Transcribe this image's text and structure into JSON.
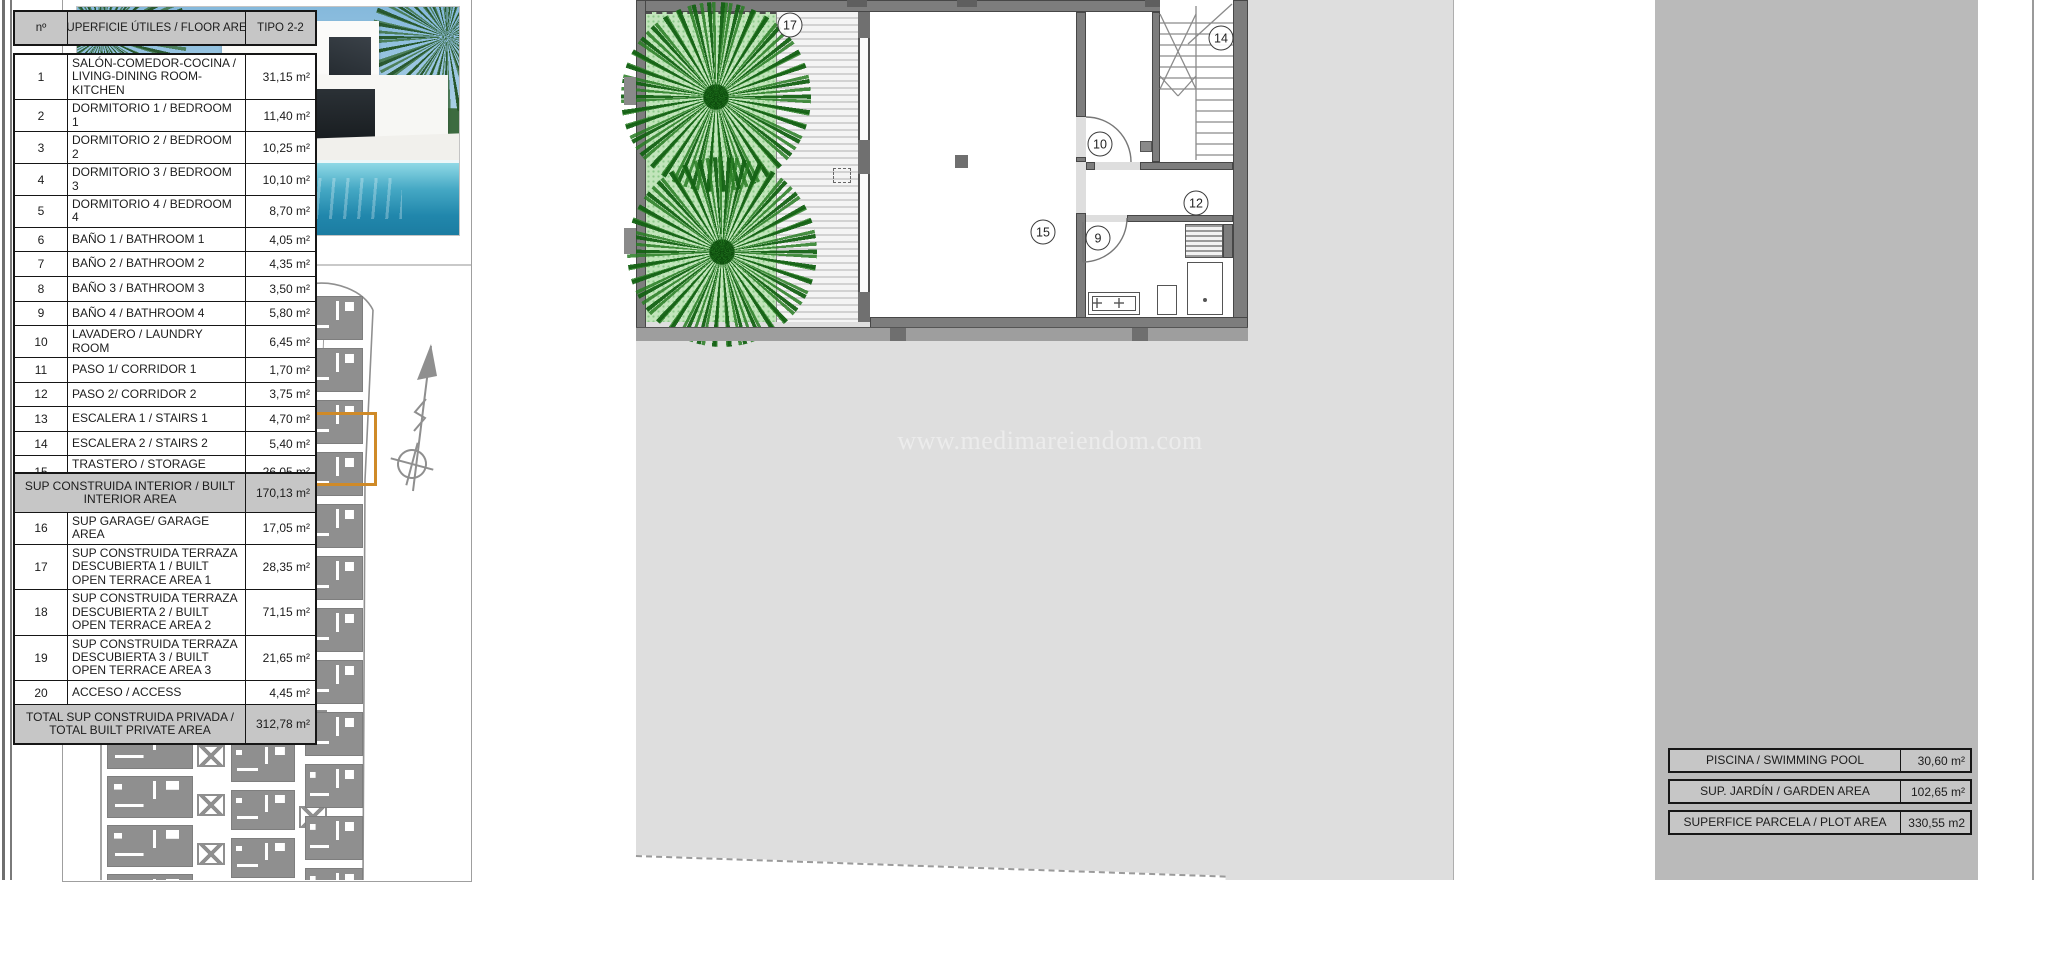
{
  "document": {
    "watermark": "www.medimareiendom.com"
  },
  "area_table": {
    "header": {
      "num": "nº",
      "desc": "SUPERFICIE ÚTILES / FLOOR AREA",
      "type": "TIPO 2-2"
    },
    "rooms": [
      {
        "num": "1",
        "label": "SALÓN-COMEDOR-COCINA / LIVING-DINING ROOM-KITCHEN",
        "value": "31,15 m²"
      },
      {
        "num": "2",
        "label": "DORMITORIO 1 / BEDROOM 1",
        "value": "11,40 m²"
      },
      {
        "num": "3",
        "label": "DORMITORIO 2 / BEDROOM 2",
        "value": "10,25 m²"
      },
      {
        "num": "4",
        "label": "DORMITORIO 3 / BEDROOM 3",
        "value": "10,10 m²"
      },
      {
        "num": "5",
        "label": "DORMITORIO 4 / BEDROOM 4",
        "value": "8,70 m²"
      },
      {
        "num": "6",
        "label": "BAÑO 1 / BATHROOM 1",
        "value": "4,05 m²"
      },
      {
        "num": "7",
        "label": "BAÑO 2 / BATHROOM 2",
        "value": "4,35 m²"
      },
      {
        "num": "8",
        "label": "BAÑO 3 / BATHROOM 3",
        "value": "3,50 m²"
      },
      {
        "num": "9",
        "label": "BAÑO 4 / BATHROOM 4",
        "value": "5,80 m²"
      },
      {
        "num": "10",
        "label": "LAVADERO / LAUNDRY ROOM",
        "value": "6,45 m²"
      },
      {
        "num": "11",
        "label": "PASO 1/ CORRIDOR 1",
        "value": "1,70 m²"
      },
      {
        "num": "12",
        "label": "PASO 2/ CORRIDOR 2",
        "value": "3,75 m²"
      },
      {
        "num": "13",
        "label": "ESCALERA 1 / STAIRS 1",
        "value": "4,70 m²"
      },
      {
        "num": "14",
        "label": "ESCALERA 2 / STAIRS 2",
        "value": "5,40 m²"
      },
      {
        "num": "15",
        "label": "TRASTERO / STORAGE ROOM",
        "value": "26,05 m²"
      }
    ],
    "built_sections": [
      {
        "type": "section",
        "label": "SUP CONSTRUIDA INTERIOR / BUILT INTERIOR AREA",
        "value": "170,13 m²"
      },
      {
        "type": "room",
        "num": "16",
        "label": "SUP GARAGE/ GARAGE AREA",
        "value": "17,05 m²"
      },
      {
        "type": "room",
        "num": "17",
        "label": "SUP CONSTRUIDA TERRAZA DESCUBIERTA 1 / BUILT OPEN TERRACE AREA 1",
        "value": "28,35 m²"
      },
      {
        "type": "room",
        "num": "18",
        "label": "SUP CONSTRUIDA TERRAZA DESCUBIERTA 2 / BUILT OPEN TERRACE AREA 2",
        "value": "71,15 m²"
      },
      {
        "type": "room",
        "num": "19",
        "label": "SUP CONSTRUIDA TERRAZA DESCUBIERTA 3 / BUILT OPEN TERRACE AREA 3",
        "value": "21,65 m²"
      },
      {
        "type": "room",
        "num": "20",
        "label": "ACCESO / ACCESS",
        "value": "4,45 m²"
      },
      {
        "type": "section",
        "label": "TOTAL SUP CONSTRUIDA PRIVADA / TOTAL BUILT PRIVATE AREA",
        "value": "312,78 m²"
      }
    ],
    "summary_boxes": [
      {
        "label": "PISCINA / SWIMMING POOL",
        "value": "30,60 m²"
      },
      {
        "label": "SUP. JARDÍN / GARDEN AREA",
        "value": "102,65 m²"
      },
      {
        "label": "SUPERFICE PARCELA / PLOT AREA",
        "value": "330,55 m2"
      }
    ]
  },
  "floor_plan": {
    "markers": [
      {
        "id": "17",
        "x": 154,
        "y": 25
      },
      {
        "id": "14",
        "x": 585,
        "y": 38
      },
      {
        "id": "10",
        "x": 464,
        "y": 144
      },
      {
        "id": "12",
        "x": 560,
        "y": 203
      },
      {
        "id": "15",
        "x": 407,
        "y": 232
      },
      {
        "id": "9",
        "x": 462,
        "y": 238
      }
    ]
  },
  "colors": {
    "highlight_orange": "#cf8a28",
    "plot_grey": "#dedede",
    "wall_grey": "#7d7d7d",
    "garden_green": "#c2e5bb",
    "table_strip_grey": "#bababa"
  }
}
